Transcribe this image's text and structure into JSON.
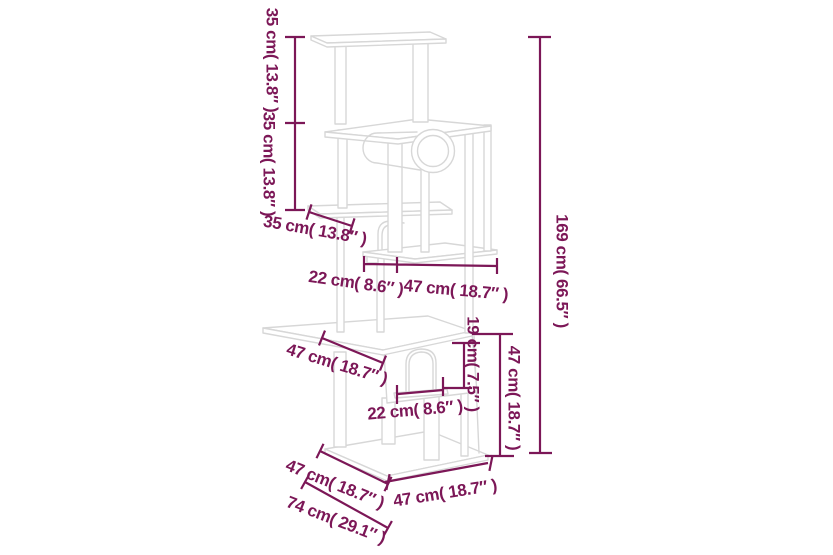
{
  "diagram": {
    "title": "cat-tree-dimension-diagram",
    "colors": {
      "dimension": "#7c1757",
      "outline": "#d7d7d7",
      "background": "#ffffff"
    },
    "dimensions": {
      "upper_section_height": "35 cm( 13.8″ )",
      "middle_section_height": "35 cm( 13.8″ )",
      "total_height": "169 cm( 66.5″ )",
      "small_platform_depth": "35 cm( 13.8″ )",
      "shelf_recess_depth": "22 cm( 8.6″ )",
      "shelf_width": "47 cm( 18.7″ )",
      "roof_platform_depth": "47 cm( 18.7″ )",
      "door_opening_height": "19 cm( 7.5″ )",
      "house_floor_width": "22 cm( 8.6″ )",
      "house_section_height": "47 cm( 18.7″ )",
      "base_side_depth": "47 cm( 18.7″ )",
      "footprint_depth": "74 cm( 29.1″ )",
      "base_front_width": "47 cm( 18.7″ )"
    }
  }
}
